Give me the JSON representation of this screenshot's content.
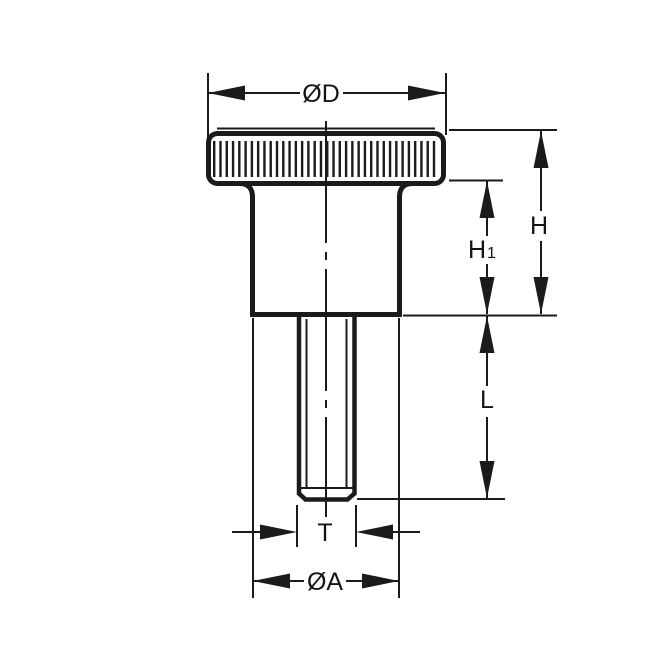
{
  "diagram": {
    "type": "technical-drawing",
    "subject": "knurled thumb knob with shoulder and threaded stud, front view with dimension callouts",
    "style": {
      "line_color": "#1b1b1b",
      "background_color": "#ffffff"
    },
    "labels": {
      "head_diameter": "ØD",
      "overall_height": "H",
      "shoulder_height_main": "H",
      "shoulder_height_sub": "1",
      "thread_length": "L",
      "thread_diameter": "T",
      "shoulder_diameter": "ØA"
    }
  }
}
